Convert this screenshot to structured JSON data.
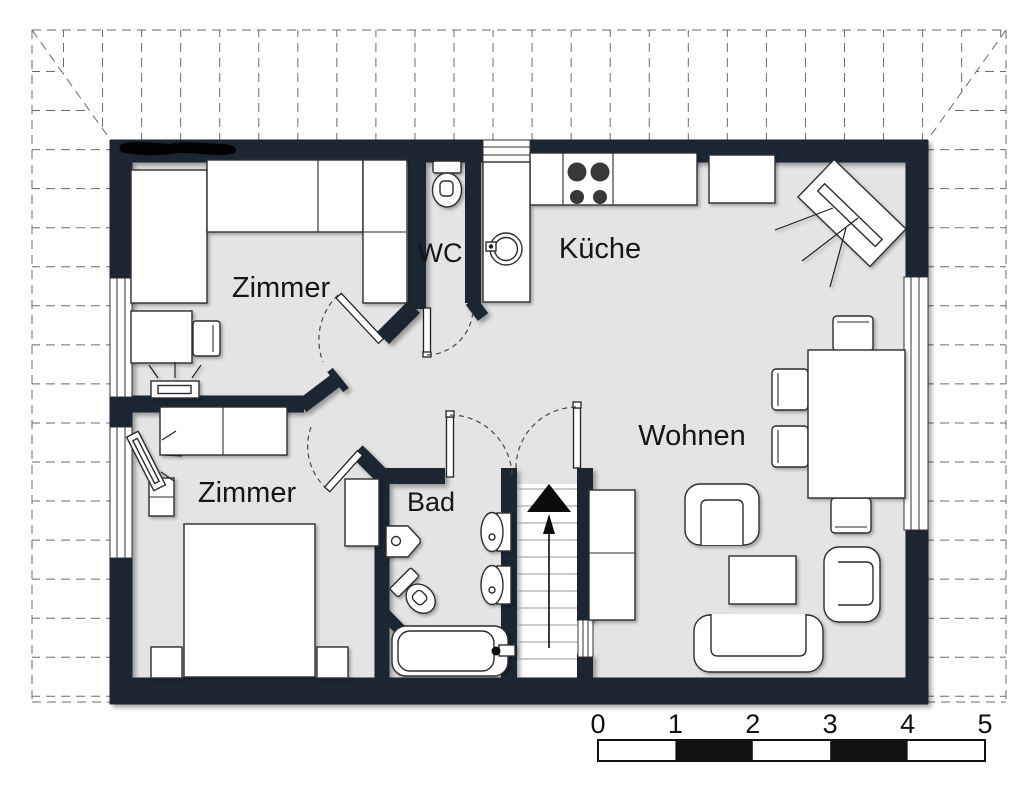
{
  "colors": {
    "wall": "#1a2530",
    "floor": "#e4e4e5",
    "grid": "#6b6b6b",
    "scale_black": "#111111"
  },
  "rooms": [
    {
      "label": "Zimmer"
    },
    {
      "label": "WC"
    },
    {
      "label": "Küche"
    },
    {
      "label": "Zimmer"
    },
    {
      "label": "Bad"
    },
    {
      "label": "Wohnen"
    }
  ],
  "scale_bar": {
    "labels": [
      "0",
      "1",
      "2",
      "3",
      "4",
      "5"
    ]
  },
  "symbols": {
    "stairs_direction": "up-arrow",
    "fixtures": [
      "wardrobe",
      "desk",
      "chair",
      "tv",
      "stove",
      "kitchen-sink",
      "toilet",
      "bidet",
      "washbasin",
      "bathtub",
      "double-bed",
      "nightstand",
      "sofa",
      "armchair",
      "coffee-table",
      "dining-table",
      "sideboard",
      "stairs",
      "door",
      "window"
    ]
  }
}
